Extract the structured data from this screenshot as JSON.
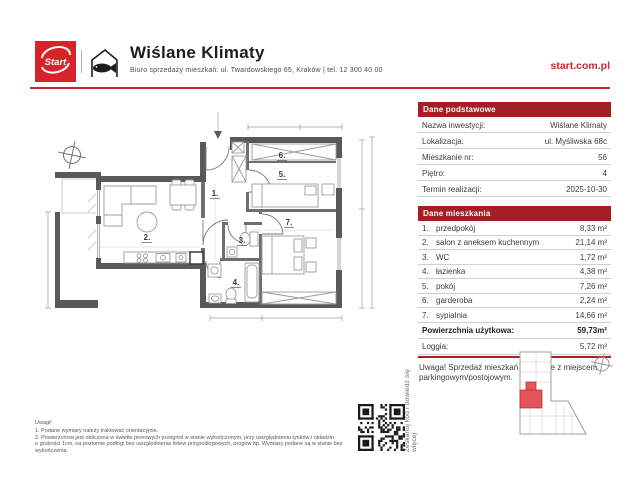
{
  "header": {
    "logo_text": "Start",
    "title": "Wiślane Klimaty",
    "subtitle": "Biuro sprzedaży mieszkań: ul. Twardowskiego 65, Kraków | tel. 12 300 40 00",
    "website": "start.com.pl"
  },
  "colors": {
    "brand_red": "#c9252c",
    "table_header_red": "#a31f24",
    "wall_gray": "#58595b",
    "unit_highlight_red": "#e4555b"
  },
  "basic_info": {
    "title": "Dane podstawowe",
    "rows": [
      {
        "label": "Nazwa inwestycji:",
        "value": "Wiślane Klimaty"
      },
      {
        "label": "Lokalizacja:",
        "value": "ul. Myśliwska 68c"
      },
      {
        "label": "Mieszkanie nr:",
        "value": "56"
      },
      {
        "label": "Piętro:",
        "value": "4"
      },
      {
        "label": "Termin realizacji:",
        "value": "2025-10-30"
      }
    ]
  },
  "apartment_info": {
    "title": "Dane mieszkania",
    "rooms": [
      {
        "no": "1.",
        "name": "przedpokój",
        "area": "8,33 m²"
      },
      {
        "no": "2.",
        "name": "salon z aneksem kuchennym",
        "area": "21,14 m²"
      },
      {
        "no": "3.",
        "name": "WC",
        "area": "1,72 m²"
      },
      {
        "no": "4.",
        "name": "łazienka",
        "area": "4,38 m²"
      },
      {
        "no": "5.",
        "name": "pokój",
        "area": "7,26 m²"
      },
      {
        "no": "6.",
        "name": "garderoba",
        "area": "2,24 m²"
      },
      {
        "no": "7.",
        "name": "sypialnia",
        "area": "14,66 m²"
      }
    ],
    "total_label": "Powierzchnia użytkowa:",
    "total_value": "59,73m²",
    "loggia_label": "Loggia:",
    "loggia_value": "5,72 m²",
    "note": "Uwaga! Sprzedaż mieszkań wyłącznie z miejscem parkingowym/postojowym."
  },
  "plan": {
    "rooms": [
      {
        "label": "1."
      },
      {
        "label": "2."
      },
      {
        "label": "3."
      },
      {
        "label": "4."
      },
      {
        "label": "5."
      },
      {
        "label": "6."
      },
      {
        "label": "7."
      }
    ]
  },
  "qr": {
    "caption": "Zeskanuj kod i dowiedz się więcej"
  },
  "footnotes": {
    "title": "Uwagi!",
    "lines": [
      "1. Podane wymiary należy traktować orientacyjnie.",
      "2. Powierzchnia jest obliczona w świetle pionowych przegród w stanie wykończonym, przy uwzględnieniu tynków i okładzin",
      "o grubości 1cm, na poziomie podłogi bez uwzględnienia listew przypodłogowych, progów itp. Wymiary podane są w stanie bez wykończenia."
    ]
  }
}
